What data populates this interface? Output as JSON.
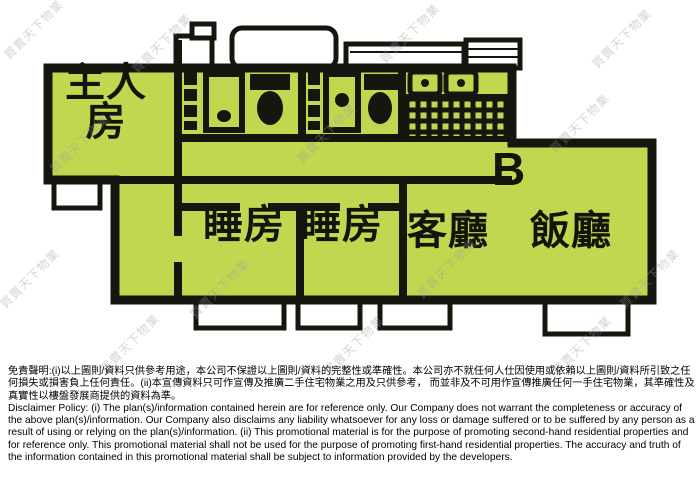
{
  "floor_plan": {
    "unit_label": "B",
    "rooms": {
      "master_bedroom": "主人房",
      "bedroom_1": "睡房",
      "bedroom_2": "睡房",
      "living_room": "客廳",
      "dining_room": "飯廳"
    },
    "colors": {
      "floor": "#c1d750",
      "wall": "#16160f",
      "background": "#ffffff"
    }
  },
  "watermark": {
    "text": "買賣天下物業",
    "color": "#9a9a9a"
  },
  "disclaimer": {
    "chinese": "免責聲明:(i)以上圖則/資料只供參考用途，本公司不保證以上圖則/資料的完整性或準確性。本公司亦不就任何人仕因使用或依賴以上圖則/資料所引致之任何損失或損害負上任何責任。(ii)本宣傳資料只可作宣傳及推廣二手住宅物業之用及只供參考， 而並非及不可用作宣傳推廣任何一手住宅物業，其準確性及真實性以樓盤發展商提供的資料為準。",
    "english": "Disclaimer Policy: (i) The plan(s)/information contained herein are for reference only. Our Company does not warrant the completeness or accuracy of the above plan(s)/information. Our Company also disclaims any liability whatsoever for any loss or damage suffered or to be suffered by any person as a result of using or relying on the plan(s)/information. (ii) This promotional material is for the purpose of promoting second-hand residential properties and for reference only. This promotional material shall not be used for the purpose of promoting first-hand residential properties. The accuracy and truth of the information contained in this promotional material shall be subject to information provided by the developers."
  }
}
